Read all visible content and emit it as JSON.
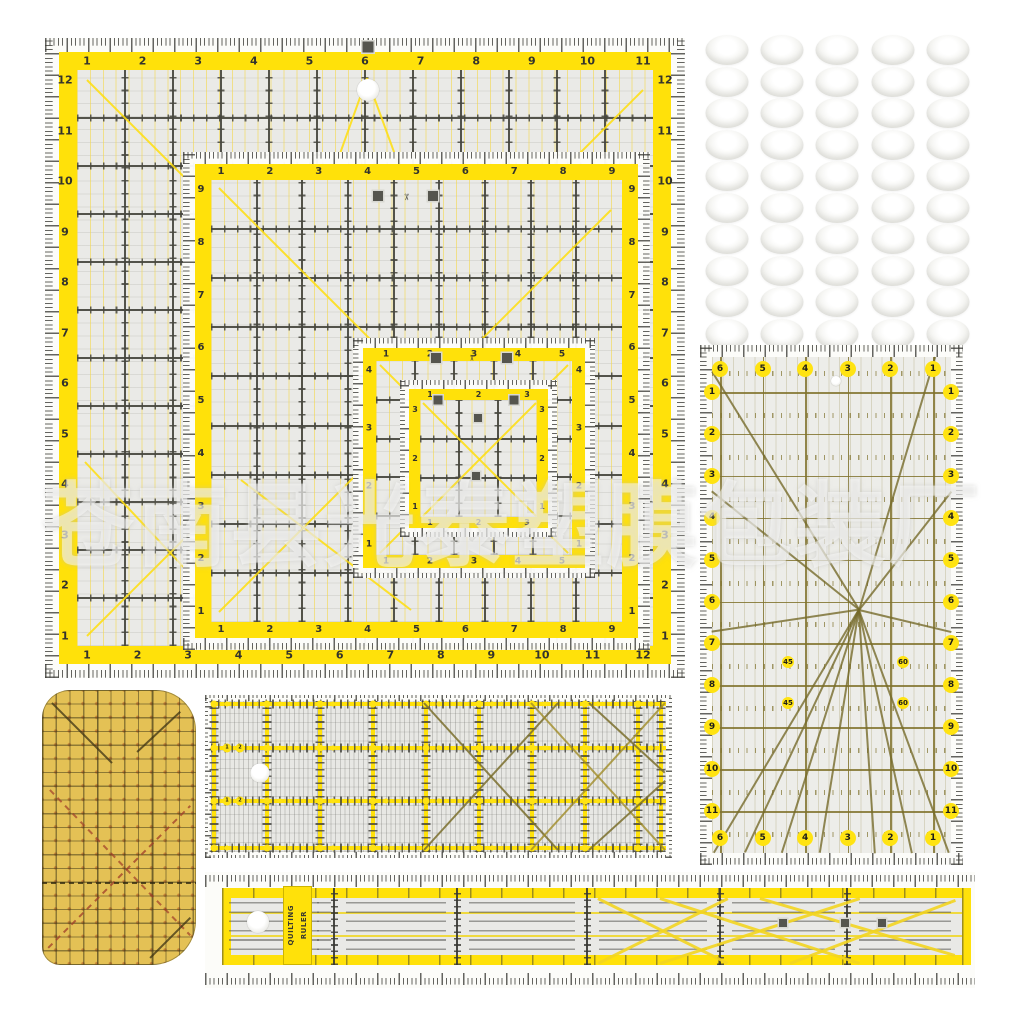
{
  "watermark": {
    "text": "苍南县光泰塑膜包装厂"
  },
  "long_ruler_label": {
    "line1": "QUILTING",
    "line2": "RULER"
  },
  "icons": {
    "scissors": "✂"
  },
  "colors": {
    "ruler_yellow": "#FFE10A",
    "body_gray": "#EAEAE7",
    "grid_dark": "#4F4F48",
    "olive": "#8A7C33",
    "badge_yellow": "#FFE312",
    "mat_yellow": "#E4C155",
    "tick_dark": "#3F3F3A"
  },
  "rulers": {
    "square_large": {
      "name": "12.5 inch square quilting ruler",
      "top": [
        "1",
        "2",
        "3",
        "4",
        "5",
        "6",
        "7",
        "8",
        "9",
        "10",
        "11"
      ],
      "bottom": [
        "1",
        "2",
        "3",
        "4",
        "5",
        "6",
        "7",
        "8",
        "9",
        "10",
        "11",
        "12"
      ],
      "left": [
        "12",
        "11",
        "10",
        "9",
        "8",
        "7",
        "6",
        "5",
        "4",
        "3",
        "2",
        "1"
      ],
      "right": [
        "12",
        "11",
        "10",
        "9",
        "8",
        "7",
        "6",
        "5",
        "4",
        "3",
        "2",
        "1"
      ]
    },
    "square_medium": {
      "name": "9.5 inch square quilting ruler",
      "top": [
        "1",
        "2",
        "3",
        "4",
        "5",
        "6",
        "7",
        "8",
        "9"
      ],
      "bottom": [
        "1",
        "2",
        "3",
        "4",
        "5",
        "6",
        "7",
        "8",
        "9"
      ],
      "left": [
        "9",
        "8",
        "7",
        "6",
        "5",
        "4",
        "3",
        "2",
        "1"
      ],
      "right": [
        "9",
        "8",
        "7",
        "6",
        "5",
        "4",
        "3",
        "2",
        "1"
      ]
    },
    "square_small": {
      "name": "5.5 inch square quilting ruler",
      "top": [
        "1",
        "2",
        "3",
        "4",
        "5"
      ],
      "bottom": [
        "1",
        "2",
        "3",
        "4",
        "5"
      ],
      "left": [
        "4",
        "3",
        "2",
        "1"
      ],
      "right": [
        "4",
        "3",
        "2",
        "1"
      ]
    },
    "square_mini": {
      "name": "3.5 inch square quilting ruler",
      "top": [
        "1",
        "2",
        "3"
      ],
      "bottom": [
        "1",
        "2",
        "3"
      ],
      "left": [
        "3",
        "2",
        "1"
      ],
      "right": [
        "3",
        "2",
        "1"
      ]
    },
    "rect_6x12": {
      "name": "6 x 12 inch angle ruler",
      "top": [
        "6",
        "5",
        "4",
        "3",
        "2",
        "1"
      ],
      "bottom": [
        "6",
        "5",
        "4",
        "3",
        "2",
        "1"
      ],
      "left": [
        "1",
        "2",
        "3",
        "4",
        "5",
        "6",
        "7",
        "8",
        "9",
        "10",
        "11"
      ],
      "right": [
        "1",
        "2",
        "3",
        "4",
        "5",
        "6",
        "7",
        "8",
        "9",
        "10",
        "11"
      ],
      "angle_labels": [
        "45",
        "60",
        "45",
        "60"
      ]
    },
    "grid_ruler": {
      "name": "patchwork grid ruler",
      "dot_numbers": [
        "1",
        "2"
      ]
    }
  },
  "grip_dots": {
    "name": "non-slip grip dots",
    "rows": 10,
    "cols": 5
  }
}
